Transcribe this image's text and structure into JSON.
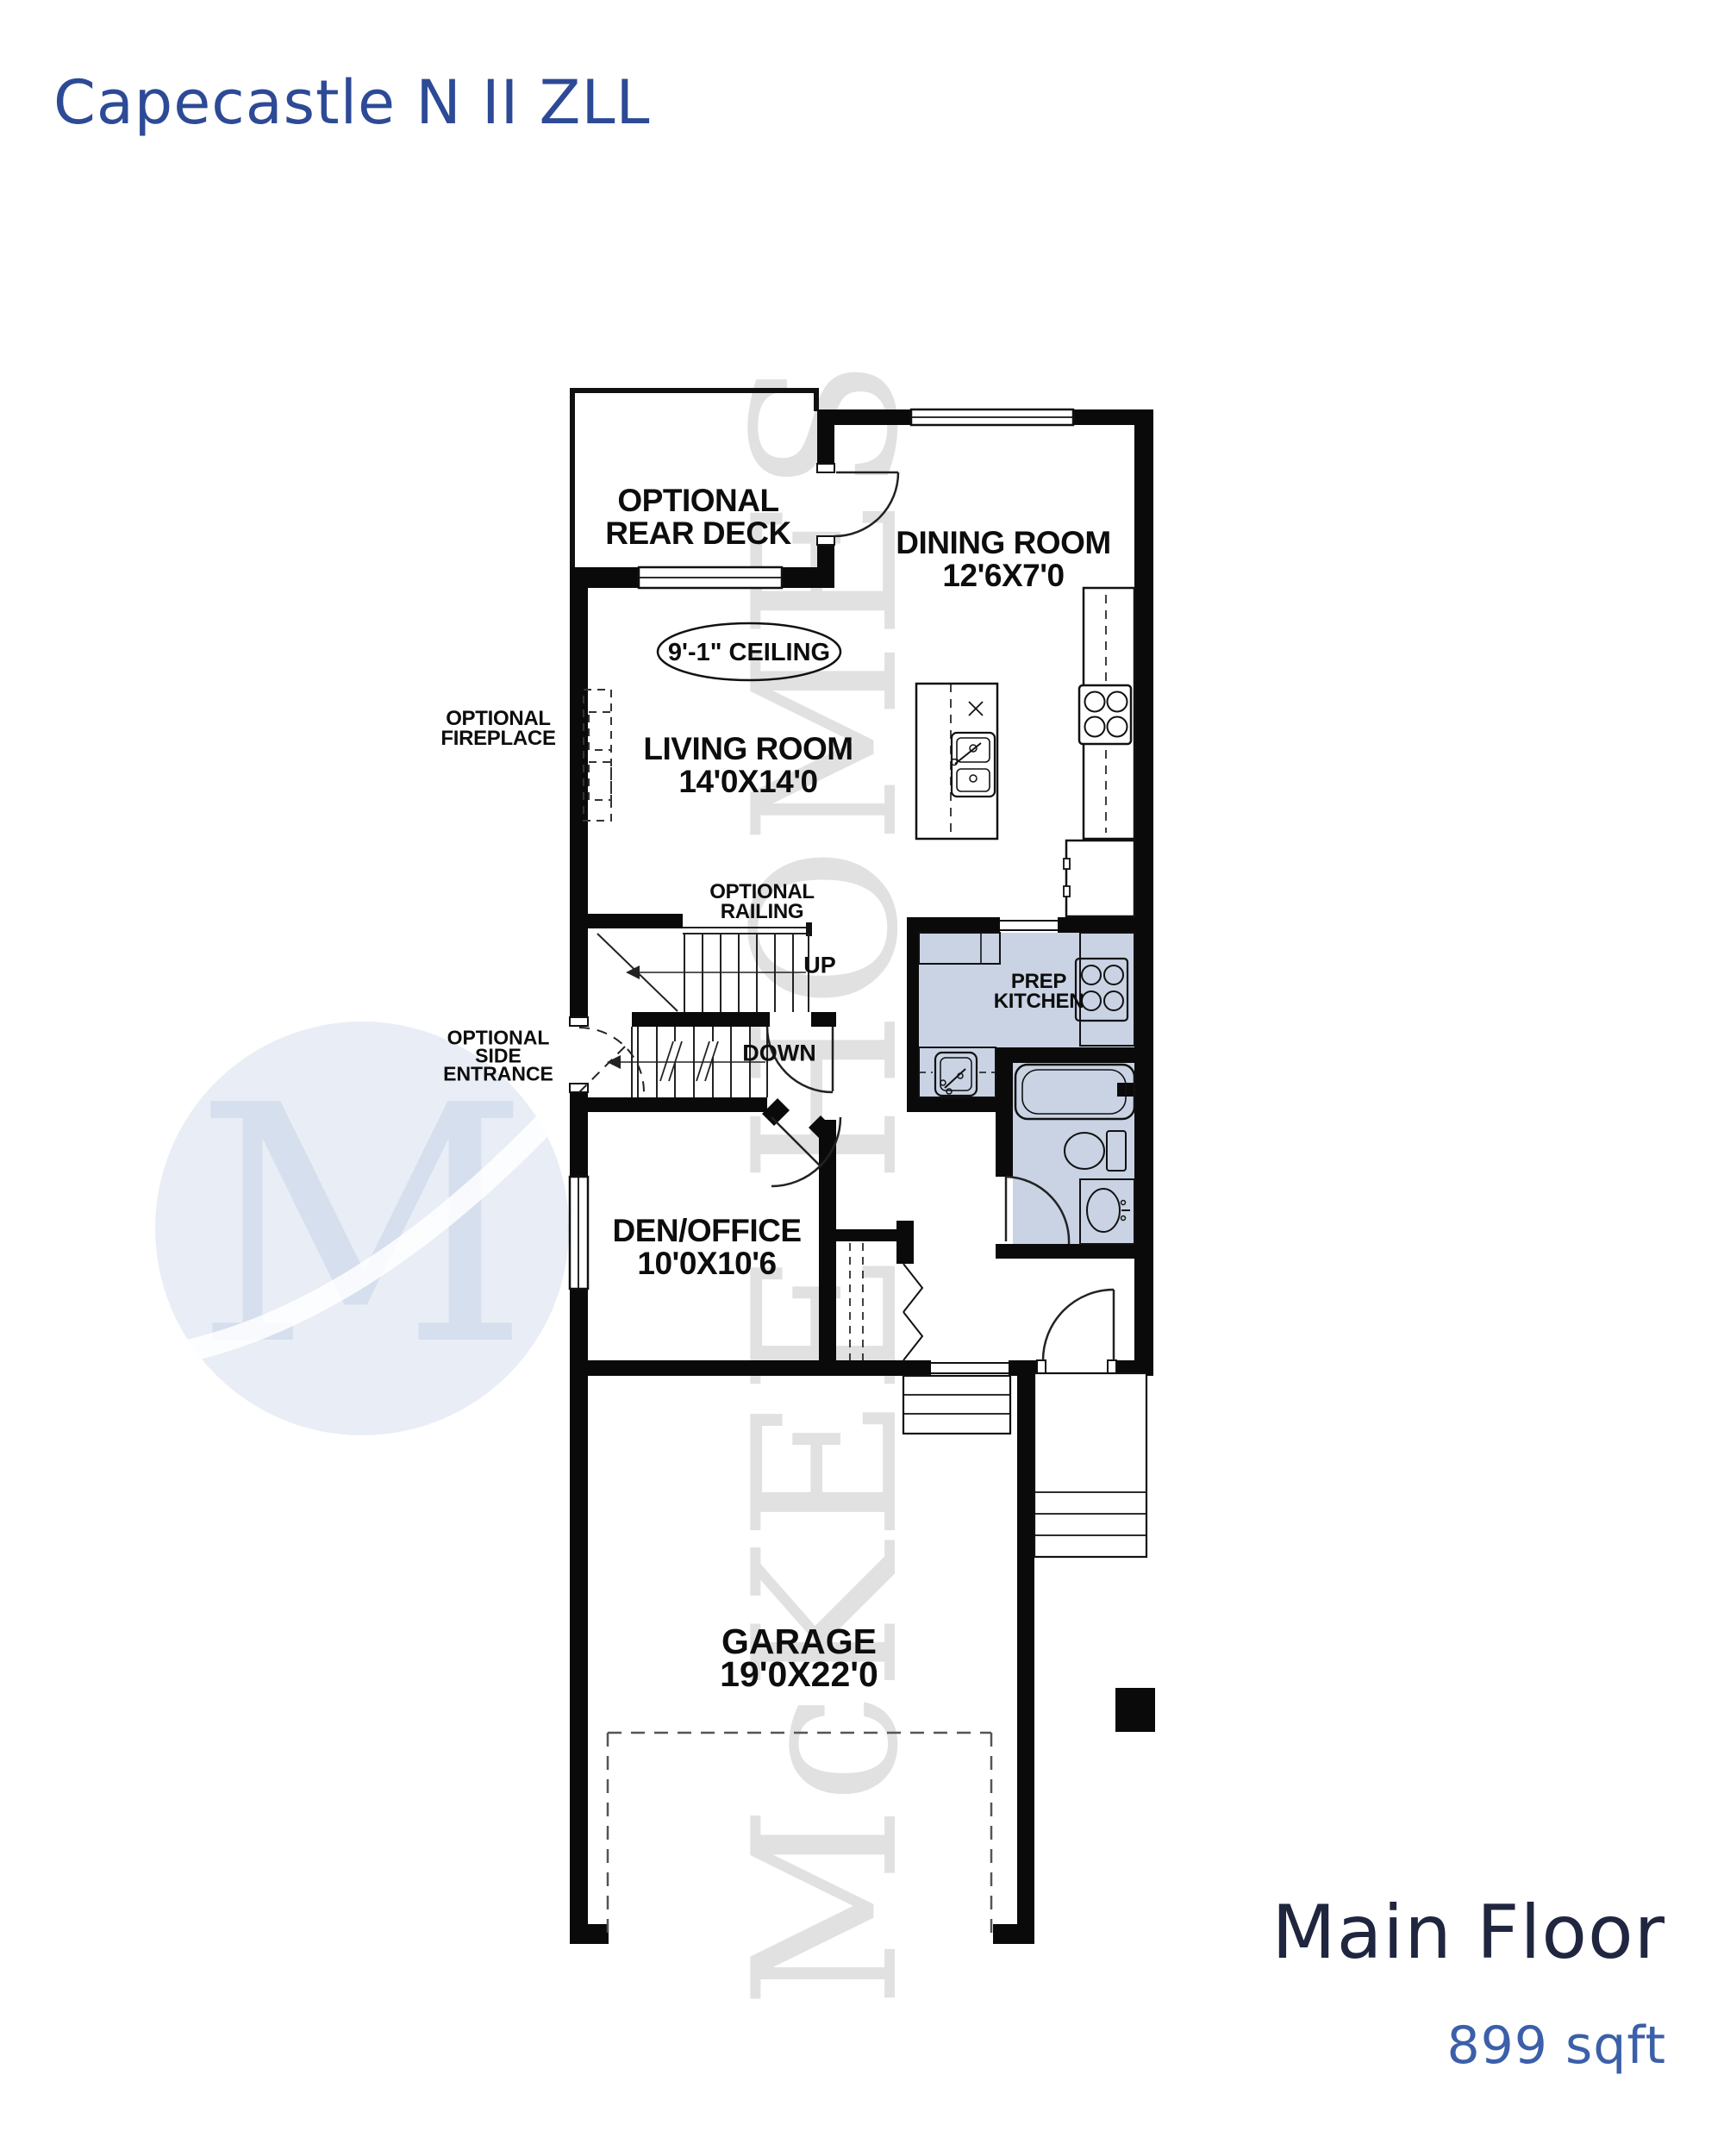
{
  "title": "Capecastle N II ZLL",
  "footer": {
    "floor": "Main Floor",
    "area": "899 sqft"
  },
  "watermark": {
    "logo_letter": "M",
    "brand": "McKEE HOMES"
  },
  "colors": {
    "title_blue": "#2d4a96",
    "floor_name_navy": "#20263f",
    "area_blue": "#3c5fa9",
    "room_fill_blue": "#c9d3e4",
    "wall_black": "#0a0a0a",
    "watermark_gray": "#e1e1e1",
    "logo_blue": "#e9edf5"
  },
  "labels": {
    "deck": {
      "l1": "OPTIONAL",
      "l2": "REAR DECK"
    },
    "dining": {
      "name": "DINING ROOM",
      "dims": "12'6X7'0"
    },
    "ceiling": "9'-1\" CEILING",
    "fireplace": {
      "l1": "OPTIONAL",
      "l2": "FIREPLACE"
    },
    "living": {
      "name": "LIVING ROOM",
      "dims": "14'0X14'0"
    },
    "railing": {
      "l1": "OPTIONAL",
      "l2": "RAILING"
    },
    "stairs": {
      "up": "UP",
      "down": "DOWN"
    },
    "side_entrance": {
      "l1": "OPTIONAL",
      "l2": "SIDE",
      "l3": "ENTRANCE"
    },
    "prep_kitchen": {
      "l1": "PREP",
      "l2": "KITCHEN"
    },
    "den": {
      "name": "DEN/OFFICE",
      "dims": "10'0X10'6"
    },
    "garage": {
      "name": "GARAGE",
      "dims": "19'0X22'0"
    }
  }
}
